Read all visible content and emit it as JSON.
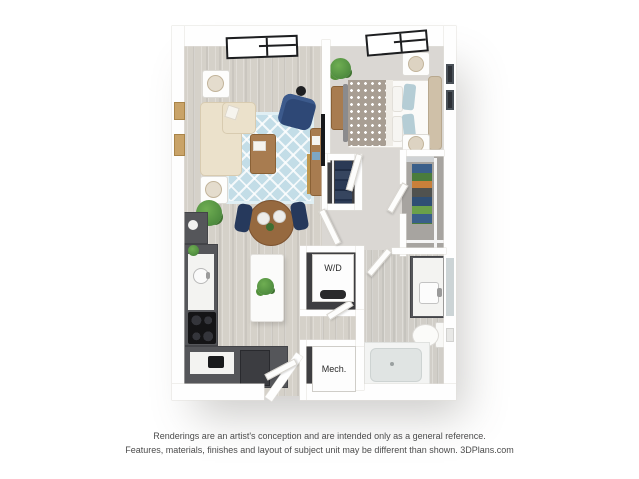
{
  "plan_labels": {
    "washer_dryer": "W/D",
    "mechanical": "Mech."
  },
  "disclaimer": {
    "line1": "Renderings are an artist's conception and are intended only as a general reference.",
    "line2": "Features, materials, finishes and layout of subject unit may be different than shown. 3DPlans.com"
  },
  "colors": {
    "background": "#ffffff",
    "wall": "#fefefe",
    "wall_edge": "#e2e0db",
    "wood_floor": "#d5d1c9",
    "bath_floor": "#d1cec8",
    "carpet": "#dad7d3",
    "walkin_floor": "#a7a4a0",
    "closet_dark": "#3e3e41",
    "cabinet_dark": "#55565a",
    "cabinet_edge": "#434448",
    "counter_white": "#f3f3f1",
    "island_white": "#fbfbfa",
    "rug_blue": "#c3dde7",
    "sofa_beige": "#ebe1cb",
    "sofa_edge": "#d8cbb0",
    "navy": "#2e4876",
    "navy_dark": "#26395c",
    "wood_furniture": "#a87c50",
    "wood_table": "#96693f",
    "duvet_taupe": "#a89e93",
    "pillow_blue": "#b5cdd5",
    "headboard_beige": "#cfc0a8",
    "plant_green": "#4d8a3e",
    "appliance_black": "#141416",
    "fridge_gray": "#3c3d41",
    "tub_gray": "#e0e4e3",
    "tile_white": "#f3f4f3",
    "window_frame": "#1d1e20",
    "gold": "#c0984e",
    "mirror_blue": "#ccd4d6",
    "art_tan": "#c9a368",
    "art_dark": "#2c3036",
    "label_text": "#2b2b2b",
    "disclaimer_text": "#4c4c4c"
  }
}
